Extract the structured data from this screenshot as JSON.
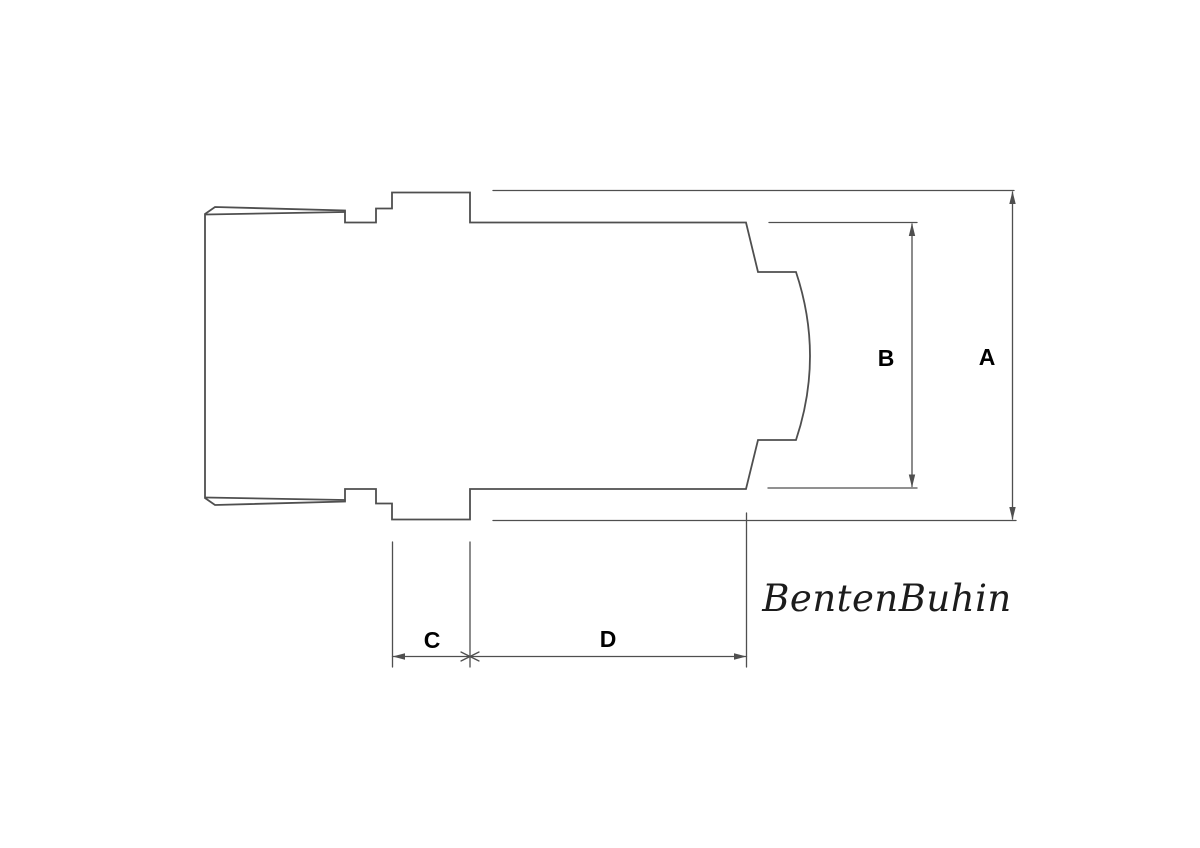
{
  "page": {
    "background_color": "#ffffff"
  },
  "drawing": {
    "type": "technical-dimension-drawing",
    "subject": "fitting cross-section profile with dimension callouts",
    "line_color": "#4f4f4f",
    "label_color": "#000000",
    "signature_color": "#1c1c1c",
    "dimension_labels": {
      "a": "A",
      "b": "B",
      "c": "C",
      "d": "D"
    },
    "signature": "BentenBuhin"
  }
}
